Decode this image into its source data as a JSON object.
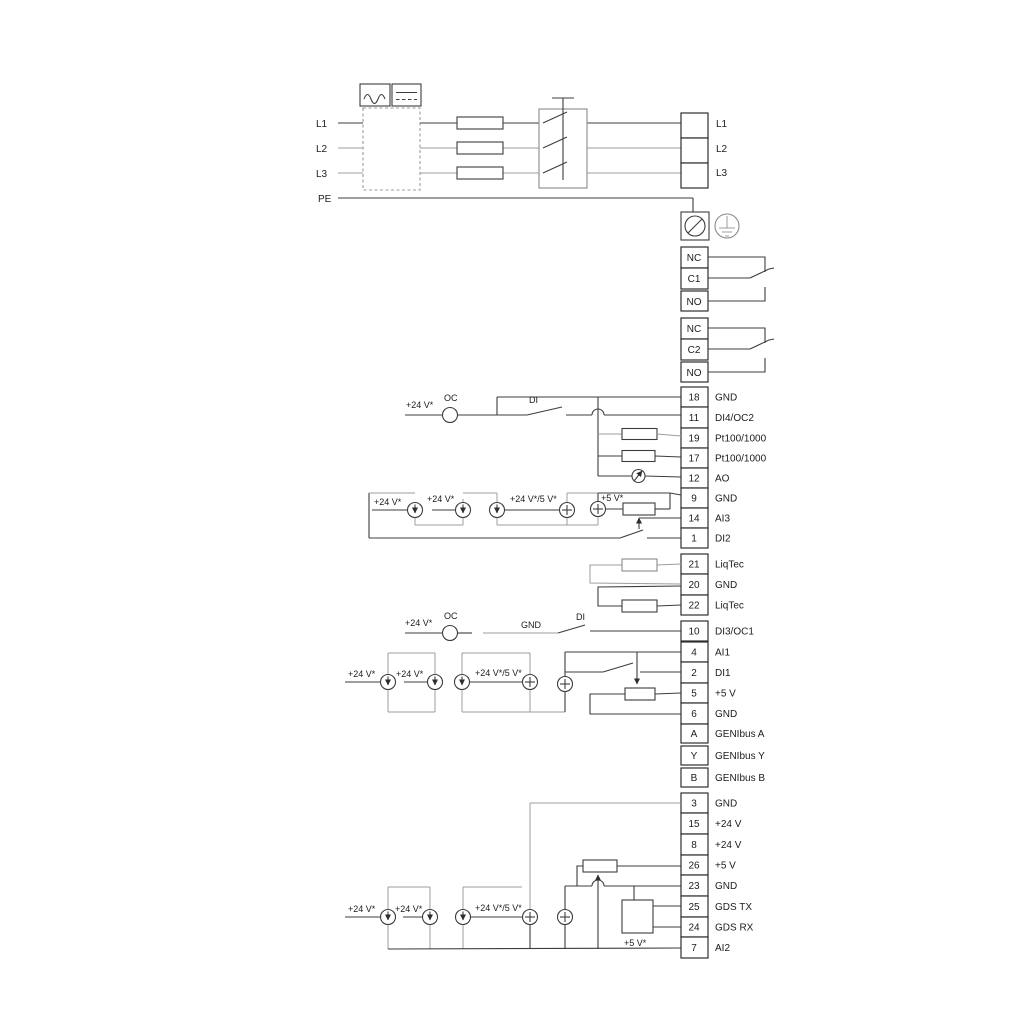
{
  "colors": {
    "wire_dark": "#3d3d3d",
    "wire_gray": "#9c9c9c",
    "text": "#1c1c1c",
    "background": "#ffffff"
  },
  "power": {
    "inputs": [
      {
        "label": "L1"
      },
      {
        "label": "L2"
      },
      {
        "label": "L3"
      },
      {
        "label": "PE"
      }
    ],
    "outputs": [
      {
        "label": "L1"
      },
      {
        "label": "L2"
      },
      {
        "label": "L3"
      }
    ]
  },
  "relays": [
    {
      "terminals": [
        {
          "label": "NC"
        },
        {
          "label": "C1"
        },
        {
          "label": "NO"
        }
      ]
    },
    {
      "terminals": [
        {
          "label": "NC"
        },
        {
          "label": "C2"
        },
        {
          "label": "NO"
        }
      ]
    }
  ],
  "terminal_groups": {
    "main": [
      {
        "num": "18",
        "label": "GND"
      },
      {
        "num": "11",
        "label": "DI4/OC2"
      },
      {
        "num": "19",
        "label": "Pt100/1000"
      },
      {
        "num": "17",
        "label": "Pt100/1000"
      },
      {
        "num": "12",
        "label": "AO"
      },
      {
        "num": "9",
        "label": "GND"
      },
      {
        "num": "14",
        "label": "AI3"
      },
      {
        "num": "1",
        "label": "DI2"
      }
    ],
    "liqtec": [
      {
        "num": "21",
        "label": "LiqTec"
      },
      {
        "num": "20",
        "label": "GND"
      },
      {
        "num": "22",
        "label": "LiqTec"
      }
    ],
    "di3": [
      {
        "num": "10",
        "label": "DI3/OC1"
      }
    ],
    "analog": [
      {
        "num": "4",
        "label": "AI1"
      },
      {
        "num": "2",
        "label": "DI1"
      },
      {
        "num": "5",
        "label": "+5 V"
      },
      {
        "num": "6",
        "label": "GND"
      }
    ],
    "genibus": [
      {
        "num": "A",
        "label": "GENIbus A"
      },
      {
        "num": "Y",
        "label": "GENIbus Y"
      },
      {
        "num": "B",
        "label": "GENIbus B"
      }
    ],
    "bottom": [
      {
        "num": "3",
        "label": "GND"
      },
      {
        "num": "15",
        "label": "+24 V"
      },
      {
        "num": "8",
        "label": "+24 V"
      },
      {
        "num": "26",
        "label": "+5 V"
      },
      {
        "num": "23",
        "label": "GND"
      },
      {
        "num": "25",
        "label": "GDS TX"
      },
      {
        "num": "24",
        "label": "GDS RX"
      },
      {
        "num": "7",
        "label": "AI2"
      }
    ]
  },
  "annotations": {
    "v24": "+24 V*",
    "v24v5": "+24 V*/5 V*",
    "v5": "+5 V*",
    "oc": "OC",
    "di": "DI",
    "gnd": "GND"
  }
}
